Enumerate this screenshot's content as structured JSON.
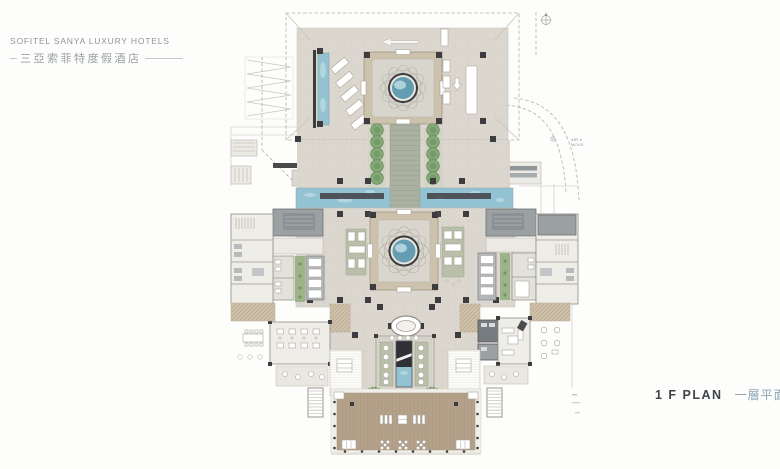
{
  "header": {
    "brand_en": "SOFITEL SANYA LUXURY HOTELS",
    "brand_cn": "三亞索菲特度假酒店"
  },
  "plan_label": {
    "en": "1 F  PLAN",
    "cn": "一層平面圖"
  },
  "annotations": {
    "air_note_line1": "AIR #",
    "air_note_line2": "MOVE"
  },
  "colors": {
    "paving": "#dbd7cf",
    "stone_path": "#abb1a1",
    "deck": "#b4a189",
    "deck_rib": "#a8957d",
    "water": "#93c2d2",
    "water_deep": "#649cb1",
    "water_light": "#bcdae4",
    "tree": "#85a877",
    "tree_dark": "#5f8455",
    "mat": "#b9bfa8",
    "wall": "#3d3d40",
    "gray_room": "#9ba0a3",
    "gray_mid": "#777c80",
    "room_light": "#efede7",
    "frame_tan": "#cdc2ac",
    "roof_tan": "#cfc0a9",
    "dash": "#b5b1a9",
    "planter_green": "#8fae7c",
    "planter_edge": "#6c8c5c",
    "header_text": "#8f969b",
    "header_cn": "#9aa0a6",
    "label_en": "#3f444a",
    "label_cn": "#8ba4b4",
    "annotation": "#8d9399"
  }
}
